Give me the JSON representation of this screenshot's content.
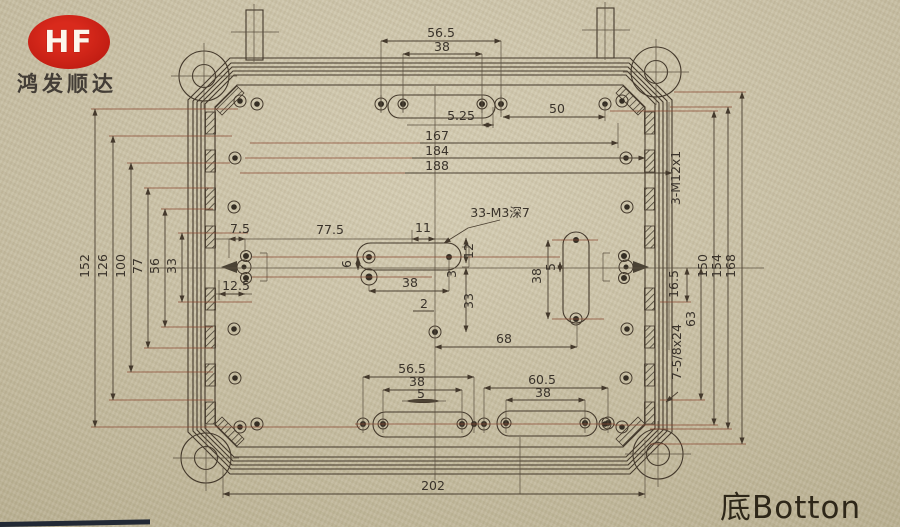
{
  "brand": {
    "logo": "HF",
    "company": "鸿发顺达"
  },
  "view": {
    "label": "底Botton"
  },
  "notes": {
    "m3_holes": "33-M3深7",
    "m12_holes": "3-M12x1",
    "conduit": "7-5/8x24"
  },
  "colors": {
    "logo_red": "#c41e14",
    "paper": "#cfc6aa",
    "ink": "#44392c"
  },
  "dims": {
    "top_outer": "56.5",
    "top_inner": "38",
    "top_offset": "5.25",
    "top_fifty": "50",
    "width_167": "167",
    "width_184": "184",
    "width_188": "188",
    "left_152": "152",
    "left_126": "126",
    "left_100": "100",
    "left_77": "77",
    "left_56": "56",
    "left_33": "33",
    "left_7_5": "7.5",
    "left_12_5": "12.5",
    "mid_77_5": "77.5",
    "mid_11": "11",
    "mid_6": "6",
    "mid_38": "38",
    "mid_2": "2",
    "mid_3": "3",
    "mid_33": "33",
    "mid_12": "12",
    "mid_68": "68",
    "plate_38": "38",
    "plate_5": "5",
    "right_16_5": "16.5",
    "right_63": "63",
    "right_150": "150",
    "right_154": "154",
    "right_168": "168",
    "bot_56_5": "56.5",
    "bot_38_l": "38",
    "bot_5": "5",
    "bot_60_5": "60.5",
    "bot_38_r": "38",
    "bot_202": "202"
  }
}
